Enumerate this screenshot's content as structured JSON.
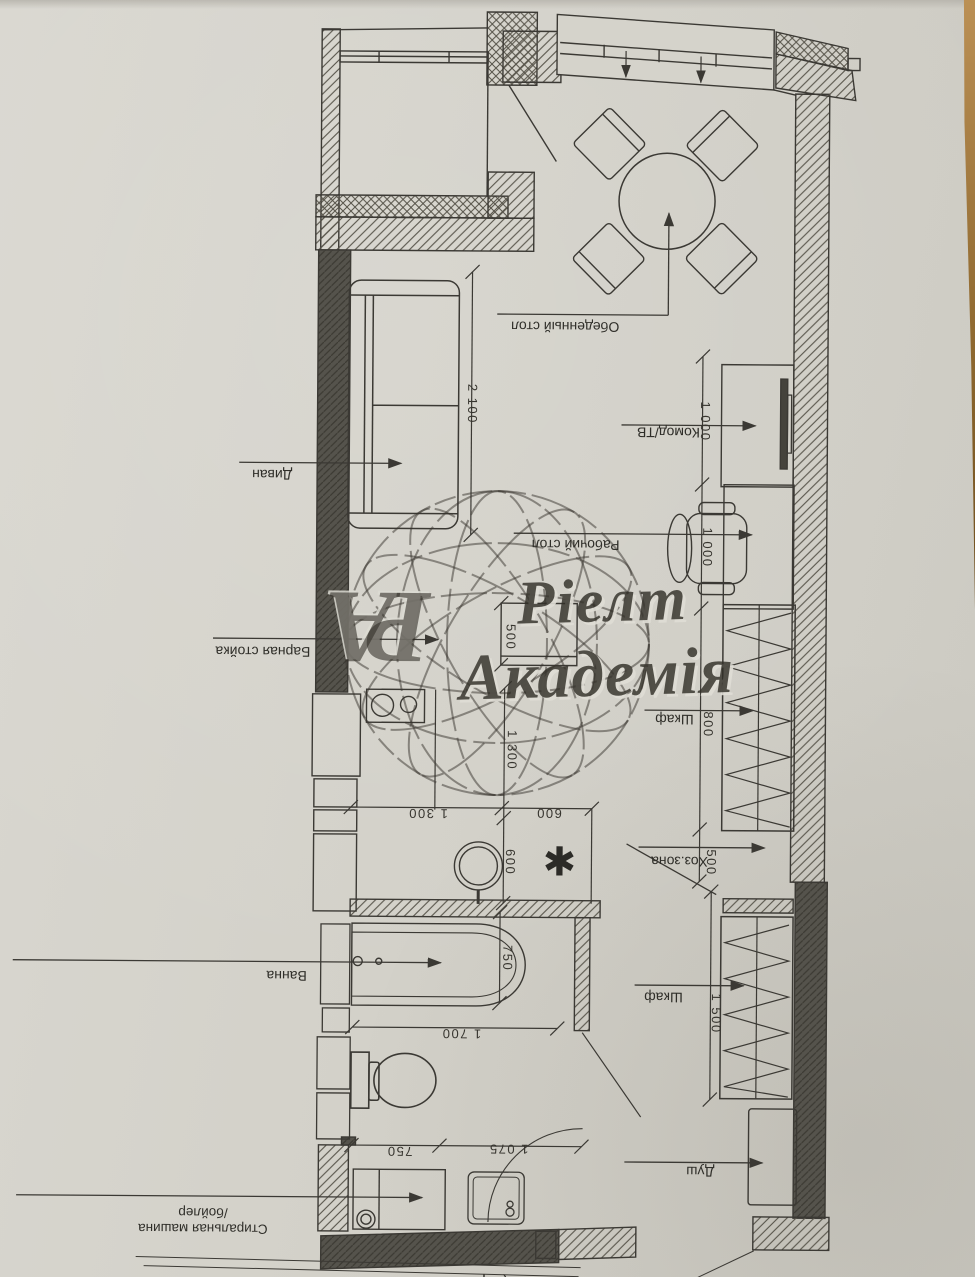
{
  "photo": {
    "paper_color": "#d3d1c9",
    "ink_color": "#3b3934",
    "dark_wall_color": "#55534c",
    "wood_table_color": "#8f6930"
  },
  "watermark": {
    "monogram": "РА",
    "line1": "Ріелт",
    "line2": "Академія"
  },
  "plan": {
    "labels": {
      "dining_table": "Обеденный стол",
      "sofa": "Диван",
      "dresser_tv": "Комод/ТВ",
      "desk": "Рабочий стол",
      "bar_counter": "Барная стойка",
      "wardrobe_upper": "Шкаф",
      "utility_zone": "Хоз.зона",
      "wardrobe_lower": "Шкаф",
      "bathtub": "Ванна",
      "shower": "Душ",
      "washing_machine_line1": "Стиральная машина",
      "washing_machine_line2": "/бойлер",
      "bottom_partial": "(вариант",
      "asterisk": "✱"
    },
    "dimensions_mm": {
      "sofa_length": "2 100",
      "dresser_width": "1 000",
      "desk_width": "1 000",
      "wardrobe_upper_width": "800",
      "utility_width": "500",
      "wardrobe_lower_width": "1 500",
      "bar_depth": "500",
      "kitchen_depth": "1 300",
      "kitchen_width": "1 300",
      "passage_width": "600",
      "passage_depth": "600",
      "bath_width": "750",
      "bath_length": "1 700",
      "wc_width": "750",
      "hall_width": "1 075"
    }
  }
}
